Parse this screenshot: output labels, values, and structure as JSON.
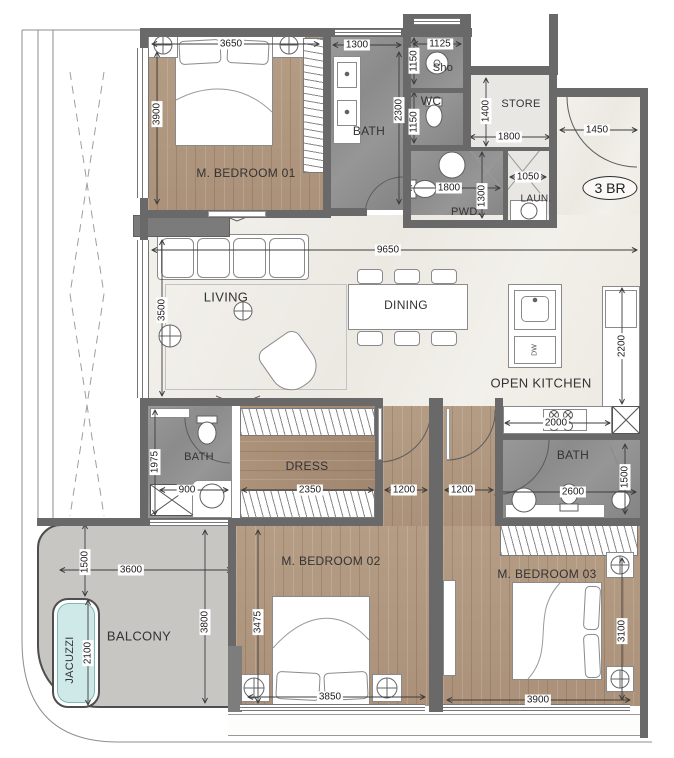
{
  "plan": {
    "badge": "3 BR",
    "rooms": {
      "bedroom1": "M. BEDROOM 01",
      "bath_top": "BATH",
      "shower": "Sho",
      "wc": "WC",
      "store": "STORE",
      "powder": "PWD.",
      "laundry": "LAUN.",
      "living": "LIVING",
      "dining": "DINING",
      "kitchen": "OPEN KITCHEN",
      "bath_mid": "BATH",
      "dress": "DRESS",
      "bath_right": "BATH",
      "bedroom2": "M. BEDROOM 02",
      "bedroom3": "M. BEDROOM 03",
      "balcony": "BALCONY",
      "jacuzzi": "JACUZZI",
      "dishwasher": "DW"
    },
    "dims": {
      "bedroom1_w": "3650",
      "bedroom1_h": "3900",
      "bath_top_w": "1300",
      "bath_top_h": "2300",
      "shower_w": "1125",
      "shower_h": "1150",
      "wc_h": "1150",
      "store_h": "1400",
      "store_w": "1800",
      "entry_w": "1450",
      "powder_w": "1800",
      "powder_h": "1300",
      "laundry_w": "1050",
      "open_w": "9650",
      "living_h": "3500",
      "kitchen_h": "2200",
      "kitchen_w": "2000",
      "bath_mid_h": "1975",
      "bath_mid_w": "900",
      "dress_w": "2350",
      "hall1_w": "1200",
      "hall2_w": "1200",
      "bath_right_w": "2600",
      "bath_right_h": "1500",
      "bedroom2_h": "3475",
      "bedroom2_w": "3850",
      "bedroom3_w": "3900",
      "bedroom3_h": "3100",
      "balcony_offset": "1500",
      "balcony_w": "3600",
      "balcony_h": "3800",
      "jacuzzi_h": "2100"
    },
    "colors": {
      "wall": "#696969",
      "wood": "#b29a82",
      "bath_tile": "#8f8f8f",
      "marble": "#f1efe9",
      "balcony": "#c7c6c3",
      "jacuzzi": "#cfe9e8"
    }
  }
}
